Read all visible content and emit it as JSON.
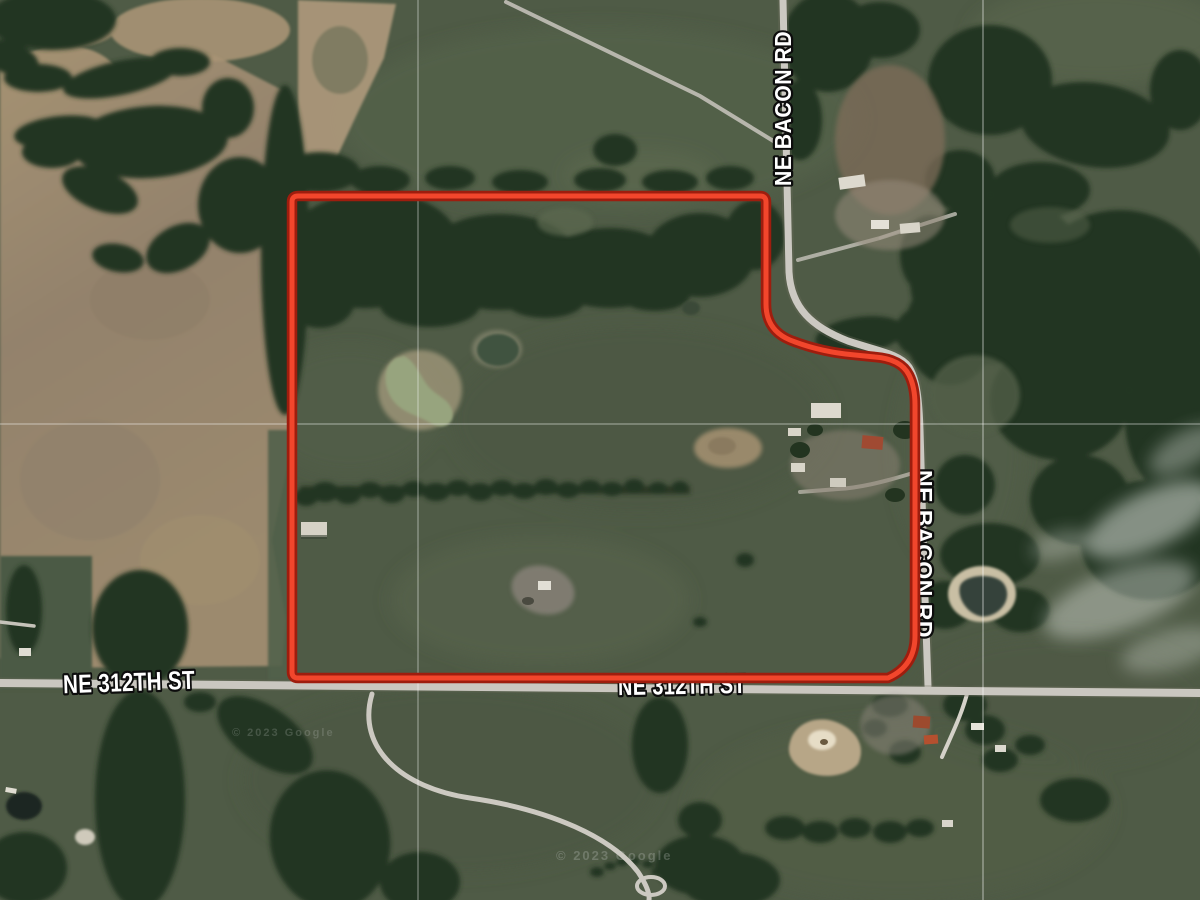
{
  "map": {
    "view_type": "satellite-aerial-imagery",
    "road_labels": {
      "bacon_top": {
        "text": "NE BACON RD"
      },
      "bacon_right": {
        "text": "NE BACON RD"
      },
      "st312_left": {
        "text": "NE 312TH ST"
      },
      "st312_mid": {
        "text": "NE 312TH ST"
      }
    },
    "watermarks": {
      "wm1": {
        "text": "© 2023 Google"
      },
      "wm2": {
        "text": "© 2023 Google"
      }
    },
    "label_style": {
      "fill": "#ffffff",
      "outline": "#0d0d0d"
    },
    "boundary": {
      "description": "red highlighted parcel outline",
      "outer_color": "#9e1d0e",
      "inner_color": "#f2462c"
    },
    "terrain_colors": {
      "pasture": "#4f5b46",
      "woods": "#233420",
      "bare_field": "#9a886d",
      "road": "#c9c6bf",
      "pond_water": "#95a37c",
      "gridline": "#ffffff"
    }
  }
}
